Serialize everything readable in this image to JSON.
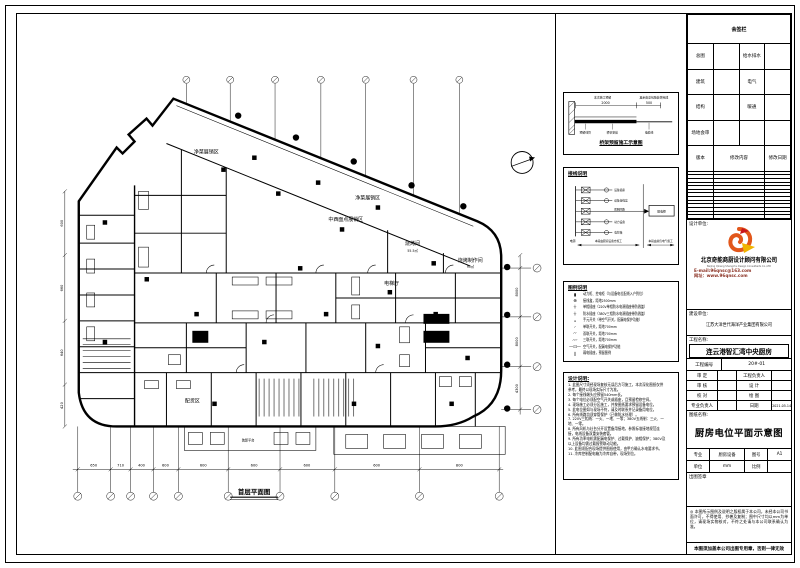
{
  "plan": {
    "title": "首层平面图",
    "rooms": [
      "净菜展销区",
      "净菜展销区",
      "中西面点展销区",
      "烧烤间",
      "烧烤制作间",
      "电梯厅",
      "配货区",
      "装卸平台"
    ],
    "areas": [
      "55.5㎡",
      "95㎡"
    ],
    "bottom_dims": [
      "650",
      "710",
      "400",
      "600",
      "600",
      "600",
      "600",
      "600",
      "800"
    ],
    "left_dims": [
      "600",
      "660",
      "640",
      "420"
    ],
    "right_dims": [
      "8000",
      "8000",
      "4300"
    ]
  },
  "detail_box": {
    "note_left": "本次施工预留",
    "note_right": "其余由总包随装饰完成",
    "dim1": "2000",
    "dim2": "500",
    "lbl1": "预留线管",
    "lbl2": "桥架安装",
    "lbl3": "电缆线",
    "title": "桥架预留施工示意图"
  },
  "system_box": {
    "title": "接线说明",
    "source": "电源",
    "branches": [
      "设备插座",
      "设备接线盒",
      "照明回路",
      "动力设备",
      "电控箱"
    ],
    "panel": "配电柜",
    "note_left": "本段由厨房设备方施工",
    "note_right": "本段由总包电气施工"
  },
  "legend": {
    "title": "图例说明",
    "items": [
      {
        "sym": "▮",
        "text": "动力柜、控电柜（与设备电位配线入户到位）"
      },
      {
        "sym": "⊕",
        "text": "接线盒，距地2500mm"
      },
      {
        "sym": "⏚",
        "text": "单相插座（220V单相防水电源插座带防溅盖）"
      },
      {
        "sym": "⏚",
        "text": "防水插座（380V三相防水电源插座带防溅盖）"
      },
      {
        "sym": "⌅",
        "text": "手元开关（带空气开关，配漏电保护功能）"
      },
      {
        "sym": "◜",
        "text": "单联开关，距地700mm"
      },
      {
        "sym": "◜◜",
        "text": "双联开关，距地700mm"
      },
      {
        "sym": "◜◜◜",
        "text": "三联开关，距地700mm"
      },
      {
        "sym": "—⊡—",
        "text": "空气开关，配漏电保护功能"
      },
      {
        "sym": "∥",
        "text": "弱电插座，预留图例"
      }
    ]
  },
  "notes": {
    "title": "设计说明:",
    "items": [
      "1. 此图尺寸须经现场复核无误后方可施工，本次深化图纸仅供参考，最终以现场实际尺寸为准。",
      "2. 每个接线端头应预留540mm长。",
      "3. 每个电位必须配空气开关或插座，且预留检修空间。",
      "4. 现场施工必须分区施工，并按图纸要求预留设备电位。",
      "5. 此电位图如与现场不符，请及时联系并记录备用电位。",
      "6. 所有线路均须穿管保护（已做防水处理）。",
      "7. 220V三相线：一火、一地、一零；380V五线制：三火、一地、一零。",
      "8. 所有风机与灶台分开设置备用接地，参照标准接地规范连接，电线设备双重安装套管。",
      "9. 所有功率电机需配漏电保护、过载保护、缺相保护；380V及以上设备均需过载报警联动功能。",
      "10. 此图须配合现场提供图纸使用，由甲方确认水电要求书。",
      "11. 冷库控制配电箱为冷库自带，现场到位。"
    ]
  },
  "sign_table": {
    "title": "会签栏",
    "rows": [
      [
        "总图",
        "给水排水"
      ],
      [
        "建筑",
        "电气"
      ],
      [
        "结构",
        "暖通"
      ],
      [
        "场地会审",
        ""
      ]
    ],
    "change_header": [
      "版本",
      "修改内容",
      "修改日期"
    ]
  },
  "firm": {
    "label": "设计单位:",
    "name_cn": "北京奇能商厨设计顾问有限公司",
    "name_en": "Beijing Qineng Shangchu Design Consultants Co.,LTD",
    "email": "E-mail:96qnsc@163.com",
    "website": "网址：www.96qnsc.com"
  },
  "client": {
    "label": "建设单位:",
    "name": "江苏大洋世代海洋产业集团有限公司"
  },
  "project": {
    "label": "工程名称:",
    "name": "连云港智汇湾中央厨房",
    "no_label": "工程编号",
    "no": "20#-01"
  },
  "approvals": [
    [
      "审 定",
      "",
      "工程负责人",
      ""
    ],
    [
      "审 核",
      "",
      "设 计",
      ""
    ],
    [
      "校 对",
      "",
      "绘 图",
      ""
    ],
    [
      "专业负责人",
      "",
      "日期",
      "2021.05.14"
    ]
  ],
  "sheet": {
    "name_label": "图纸名称:",
    "title": "厨房电位平面示意图",
    "spec": [
      [
        "专业",
        "厨房设备",
        "图号",
        "A1"
      ],
      [
        "单位",
        "mm",
        "比例",
        ""
      ]
    ],
    "stamp_label": "出图签章",
    "disclaimer": "◎ 本图所示图例及说明之版权属于本公司，未经本公司书面许可，不得使用、抄袭及复制；图中尺寸均以mm为单位，请现场实物核对，不符之处请与本公司联系确认为准。",
    "notice": "本图须加盖本公司出图专用章，否则一律无效"
  },
  "colors": {
    "logo_orange": "#e2571b",
    "logo_yellow": "#f0b400",
    "contact_red": "#8b3224"
  }
}
